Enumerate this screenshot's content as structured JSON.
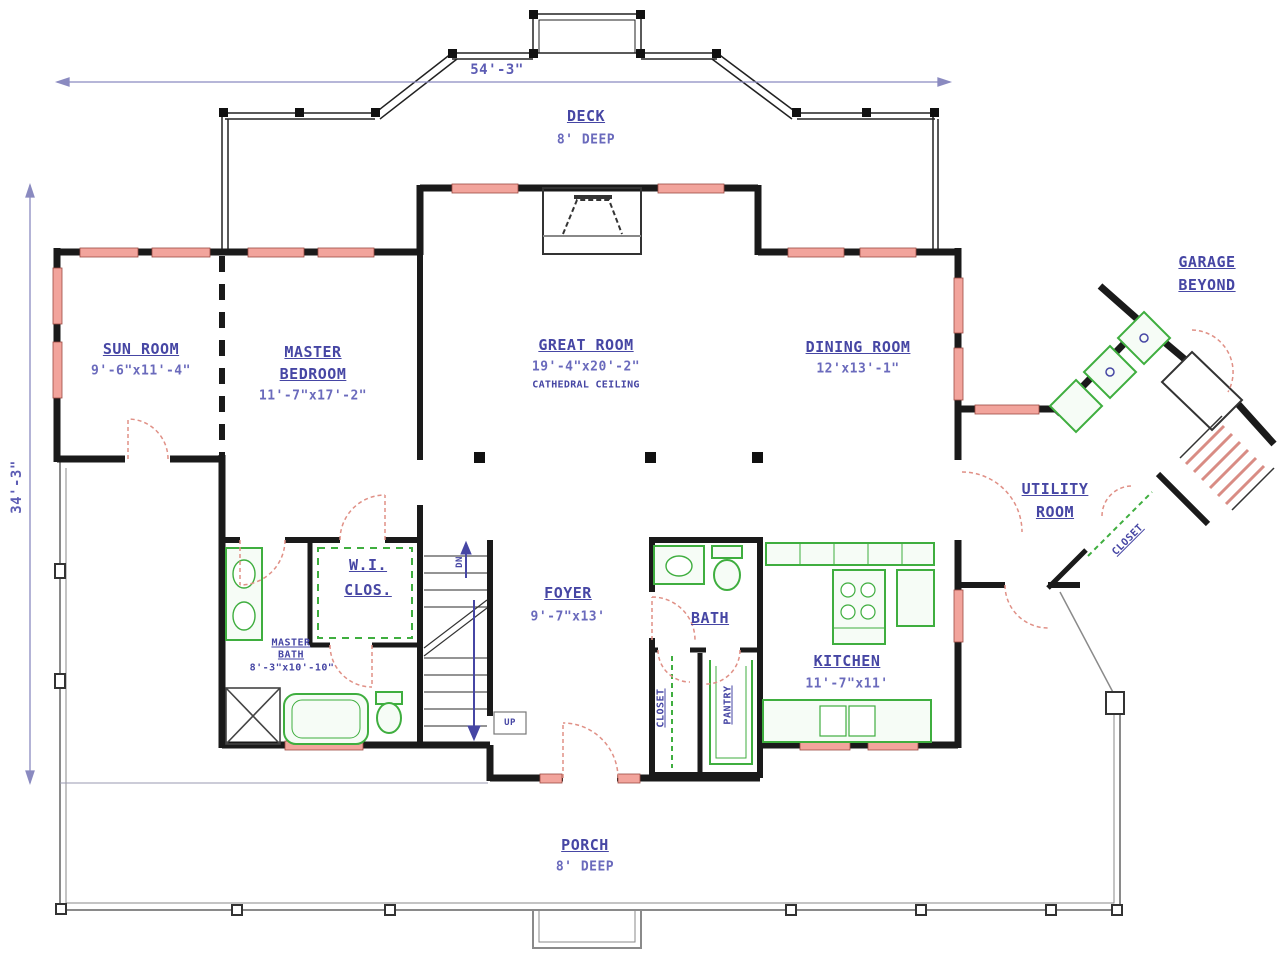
{
  "drawing": {
    "dimensions": {
      "overall_width": "54'-3\"",
      "overall_depth": "34'-3\""
    },
    "rooms": {
      "deck": {
        "name": "DECK",
        "size": "8' DEEP"
      },
      "sun_room": {
        "name": "SUN ROOM",
        "size": "9'-6\"x11'-4\""
      },
      "master_bedroom": {
        "name_line1": "MASTER",
        "name_line2": "BEDROOM",
        "size": "11'-7\"x17'-2\""
      },
      "great_room": {
        "name": "GREAT ROOM",
        "size": "19'-4\"x20'-2\"",
        "note": "CATHEDRAL CEILING"
      },
      "dining_room": {
        "name": "DINING ROOM",
        "size": "12'x13'-1\""
      },
      "garage": {
        "name_line1": "GARAGE",
        "name_line2": "BEYOND"
      },
      "utility_room": {
        "name_line1": "UTILITY",
        "name_line2": "ROOM"
      },
      "hall_closet": {
        "name": "CLOSET"
      },
      "walk_in_closet": {
        "name_line1": "W.I.",
        "name_line2": "CLOS."
      },
      "master_bath": {
        "name_line1": "MASTER",
        "name_line2": "BATH",
        "size": "8'-3\"x10'-10\""
      },
      "foyer": {
        "name": "FOYER",
        "size": "9'-7\"x13'"
      },
      "bath": {
        "name": "BATH"
      },
      "closet": {
        "name": "CLOSET"
      },
      "pantry": {
        "name": "PANTRY"
      },
      "kitchen": {
        "name": "KITCHEN",
        "size": "11'-7\"x11'"
      },
      "porch": {
        "name": "PORCH",
        "size": "8' DEEP"
      }
    },
    "stairs": {
      "up": "UP",
      "down": "DN"
    },
    "colors": {
      "wall": "#1a1a1a",
      "window": "#f2a49c",
      "fixture_green": "#3fae3f",
      "door_swing": "#e09086",
      "label_blue": "#4646a4",
      "dimension_line": "#8a8ac0",
      "porch_line": "#8a8a8a"
    }
  }
}
